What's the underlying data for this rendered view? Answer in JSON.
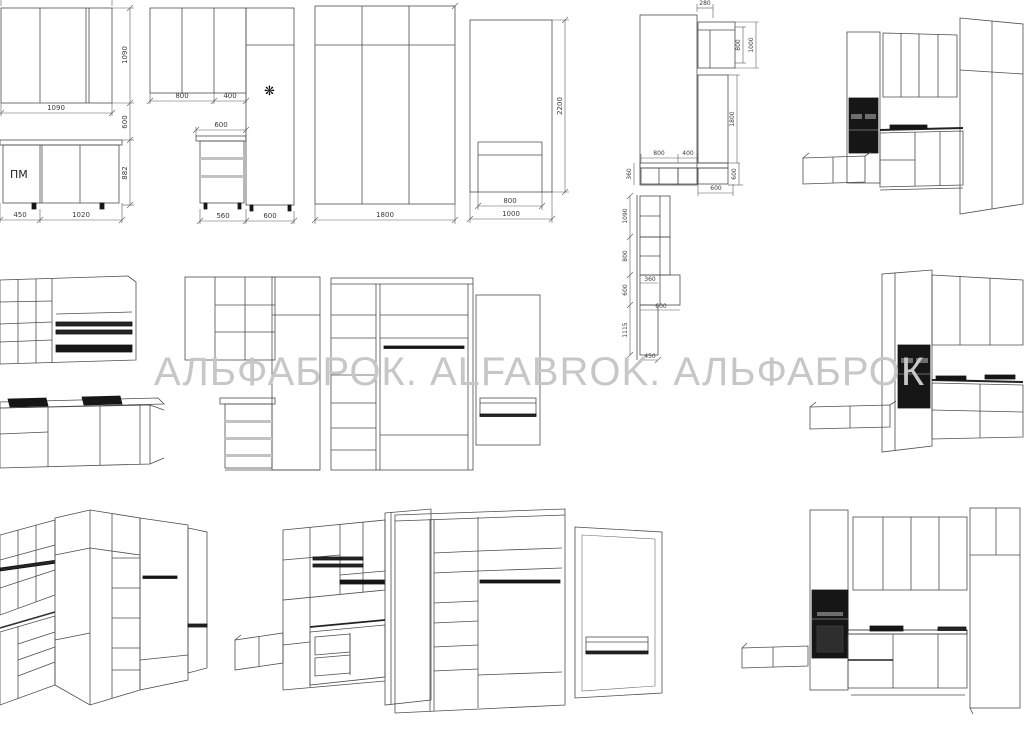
{
  "watermark": {
    "text": "АЛЬФАБРОК. ALFABROK. АЛЬФАБРОК",
    "color": "#c7c7c7"
  },
  "elevA": {
    "dim_width": "1090",
    "dim_height": "1090",
    "dim_gap": "600",
    "dim_base_height": "882",
    "dim_base_left": "450",
    "dim_base_right": "1020",
    "label_pm": "ПМ"
  },
  "elevB": {
    "dim_800": "800",
    "dim_400": "400",
    "dim_600_top": "600",
    "dim_560": "560",
    "dim_600_bottom": "600",
    "freezer_icon": "❋"
  },
  "wardrobeC": {
    "dim_1800": "1800"
  },
  "panelD": {
    "dim_2200": "2200",
    "dim_800": "800",
    "dim_1000": "1000"
  },
  "cornerE": {
    "dim_280": "280",
    "dim_800_v": "800",
    "dim_1000_v": "1000",
    "dim_1800": "1800",
    "dim_800_h": "800",
    "dim_400_h": "400",
    "dim_360": "360",
    "dim_600_v": "600",
    "dim_600_b": "600"
  },
  "planE": {
    "dim_1090": "1090",
    "dim_800": "800",
    "dim_600": "600",
    "dim_1115": "1115",
    "dim_360": "360",
    "dim_600_h": "600",
    "dim_450": "450"
  },
  "colors": {
    "line": "#4d4d4d",
    "appliance": "#161616",
    "watermark": "#c7c7c7"
  }
}
